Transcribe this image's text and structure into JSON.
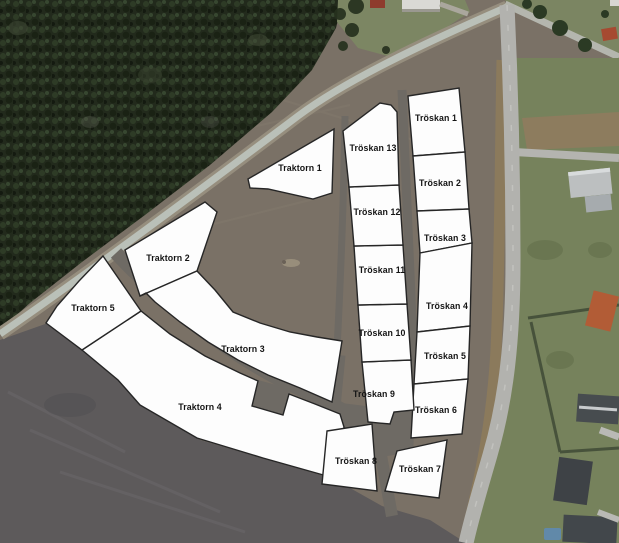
{
  "map": {
    "width": 619,
    "height": 543,
    "colors": {
      "plot_fill": "#fdfdfd",
      "plot_stroke": "#262626",
      "label_color": "#141414",
      "forest": "#222a1c",
      "field": "#7a7166",
      "dark_field": "#5d5a5b",
      "dirt_road": "#6e6a64",
      "paved_road": "#b2b2ae",
      "lawn": "#76825c",
      "hedge": "#8d7c5e"
    },
    "plots": [
      {
        "id": "traktorn-1",
        "label": "Traktorn 1",
        "label_x": 300,
        "label_y": 168,
        "points": "248,179 334,129 332,193 313,199 268,189 250,188"
      },
      {
        "id": "traktorn-2",
        "label": "Traktorn 2",
        "label_x": 168,
        "label_y": 258,
        "points": "125,250 205,202 217,212 197,271 140,296"
      },
      {
        "id": "traktorn-3",
        "label": "Traktorn 3",
        "label_x": 243,
        "label_y": 349,
        "points": "140,296 197,271 215,290 233,312 260,323 290,332 317,337 342,341 337,372 332,402 300,388 268,375 238,360 208,342 180,322 155,302 146,293"
      },
      {
        "id": "traktorn-4",
        "label": "Traktorn 4",
        "label_x": 200,
        "label_y": 407,
        "points": "82,350 141,311 170,334 205,356 240,373 258,381 252,406 283,415 289,394 315,404 340,414 344,427 334,478 263,458 197,438 140,405 118,380"
      },
      {
        "id": "traktorn-5",
        "label": "Traktorn 5",
        "label_x": 93,
        "label_y": 308,
        "points": "103,256 79,281 57,306 46,323 82,350 141,311"
      },
      {
        "id": "troskan-1",
        "label": "Tröskan 1",
        "label_x": 436,
        "label_y": 118,
        "points": "408,96 459,88 465,152 413,156"
      },
      {
        "id": "troskan-2",
        "label": "Tröskan 2",
        "label_x": 440,
        "label_y": 183,
        "points": "413,156 465,152 469,209 417,211"
      },
      {
        "id": "troskan-3",
        "label": "Tröskan 3",
        "label_x": 445,
        "label_y": 238,
        "points": "417,211 469,209 472,243 420,253"
      },
      {
        "id": "troskan-4",
        "label": "Tröskan 4",
        "label_x": 447,
        "label_y": 306,
        "points": "420,253 472,243 470,326 417,332"
      },
      {
        "id": "troskan-5",
        "label": "Tröskan 5",
        "label_x": 445,
        "label_y": 356,
        "points": "417,332 470,326 468,379 414,384"
      },
      {
        "id": "troskan-6",
        "label": "Tröskan 6",
        "label_x": 436,
        "label_y": 410,
        "points": "414,384 468,379 462,434 411,438"
      },
      {
        "id": "troskan-7",
        "label": "Tröskan 7",
        "label_x": 420,
        "label_y": 469,
        "points": "397,451 447,440 439,498 385,491"
      },
      {
        "id": "troskan-8",
        "label": "Tröskan 8",
        "label_x": 356,
        "label_y": 461,
        "points": "327,431 372,424 377,491 322,484"
      },
      {
        "id": "troskan-9",
        "label": "Tröskan 9",
        "label_x": 374,
        "label_y": 394,
        "points": "362,362 411,360 414,410 394,412 390,424 368,422"
      },
      {
        "id": "troskan-10",
        "label": "Tröskan 10",
        "label_x": 382,
        "label_y": 333,
        "points": "358,305 407,304 411,360 362,362"
      },
      {
        "id": "troskan-11",
        "label": "Tröskan 11",
        "label_x": 382,
        "label_y": 270,
        "points": "354,246 403,245 407,304 358,305"
      },
      {
        "id": "troskan-12",
        "label": "Tröskan 12",
        "label_x": 377,
        "label_y": 212,
        "points": "349,187 399,185 403,245 354,246"
      },
      {
        "id": "troskan-13",
        "label": "Tröskan 13",
        "label_x": 373,
        "label_y": 148,
        "points": "343,131 380,103 391,105 397,112 399,185 349,187"
      }
    ]
  }
}
